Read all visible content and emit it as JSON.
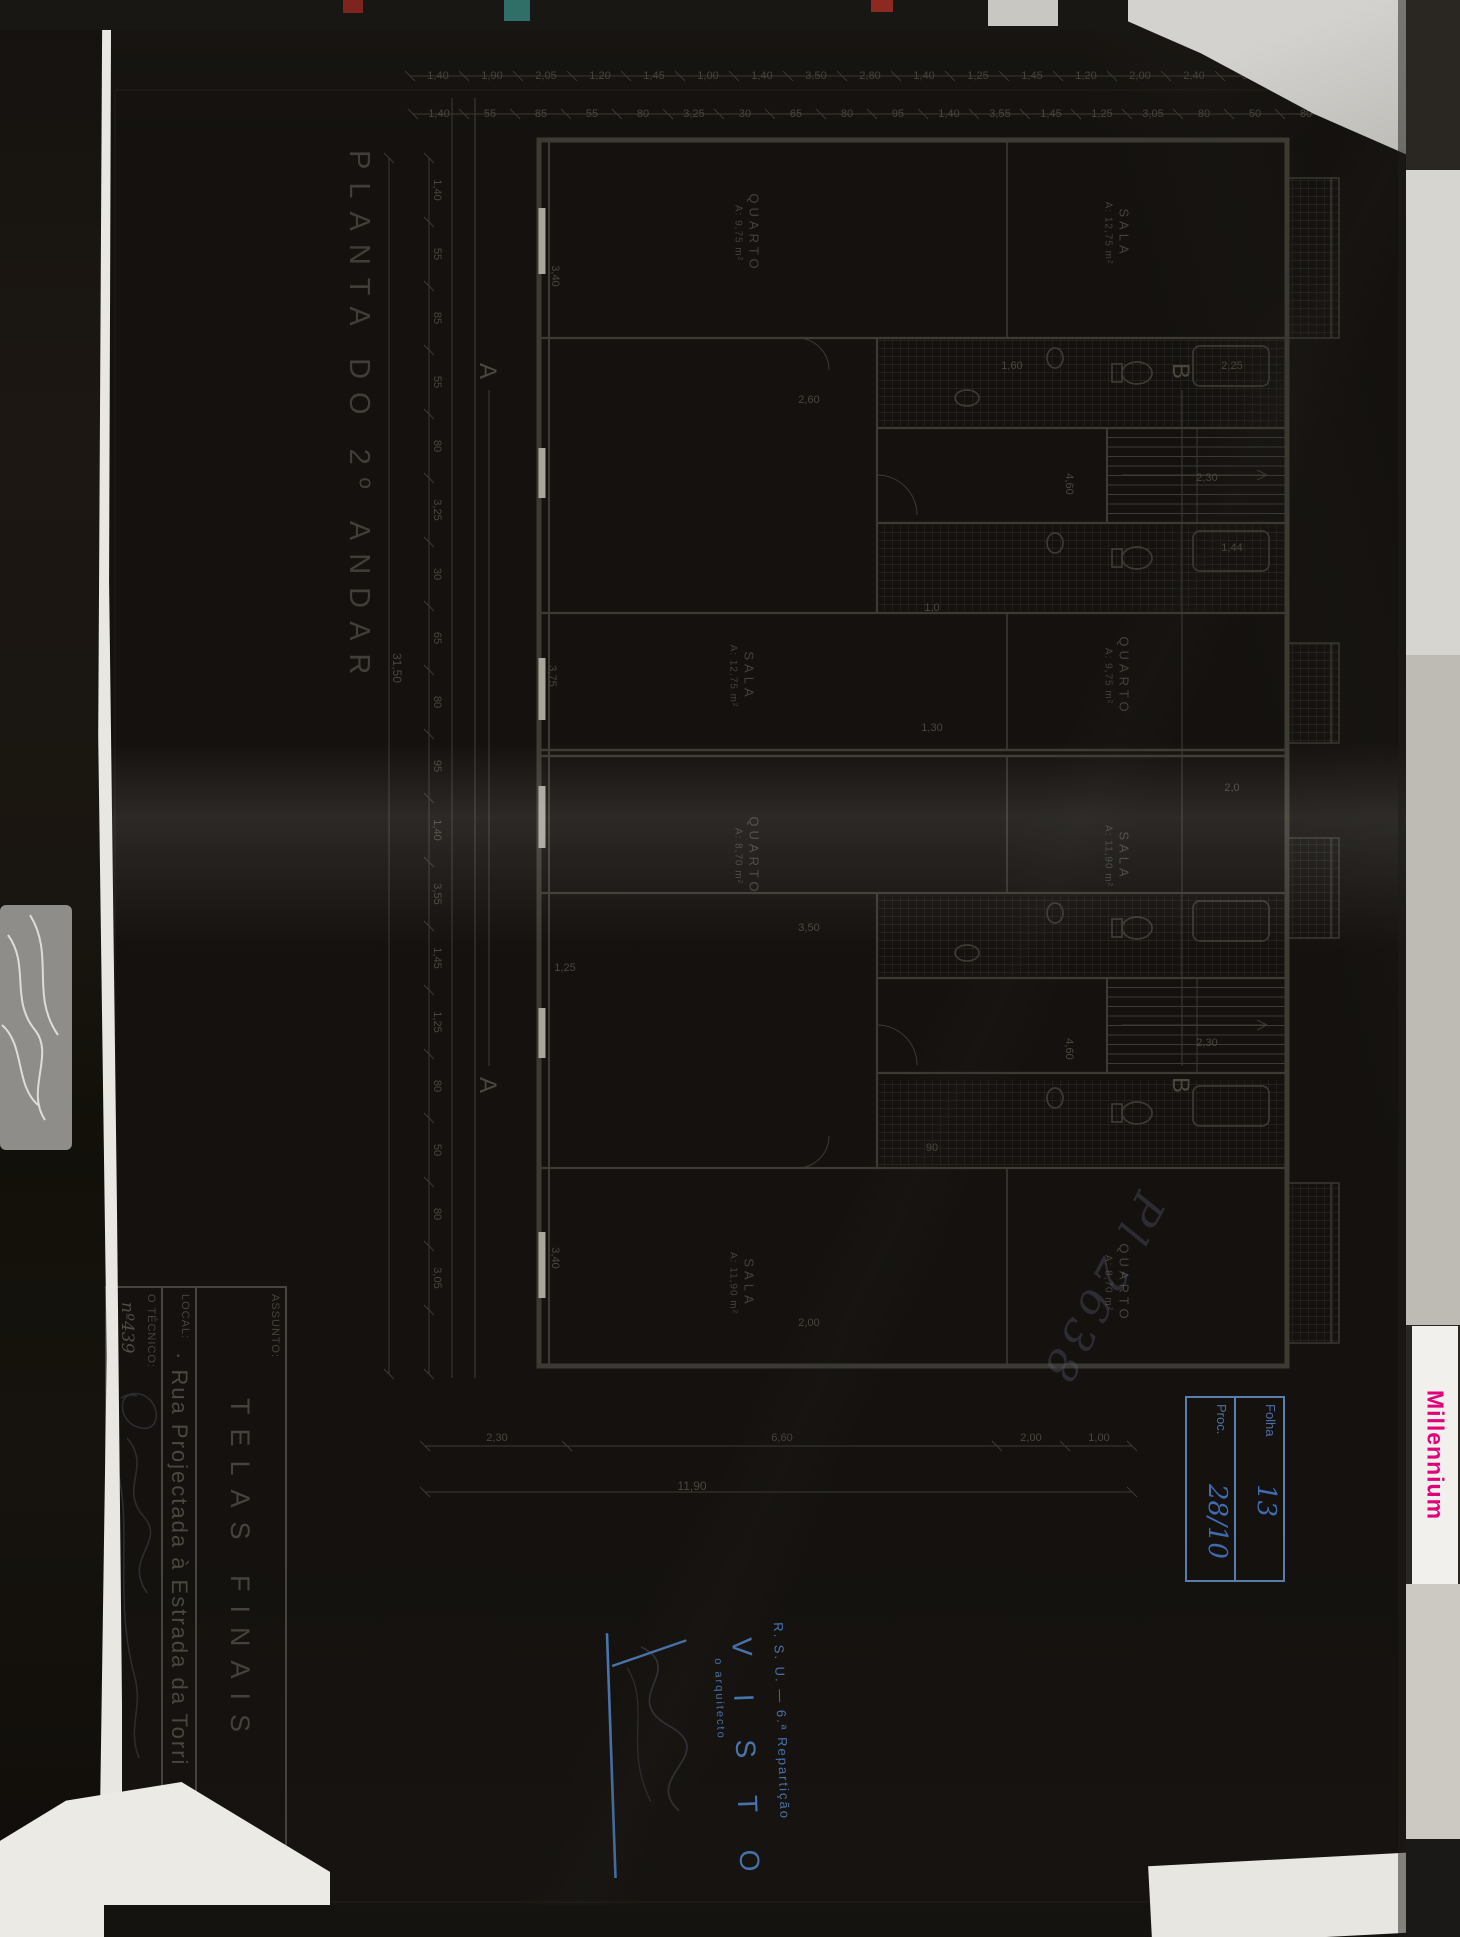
{
  "surroundings": {
    "millennium_text": "Millennium",
    "accent_magenta": "#e2007a",
    "stamp_blue": "#4a78b4",
    "paper_color": "#a7a49a",
    "ink_color": "#3b3933"
  },
  "drawing": {
    "caption": "PLANTA  DO  2º  ANDAR",
    "scribble": "Pl 2638",
    "rooms": [
      {
        "name": "SALA",
        "area": "A: 12,75 m²",
        "x": 205,
        "y": 320
      },
      {
        "name": "QUARTO",
        "area": "A: 9,75 m²",
        "x": 205,
        "y": 690
      },
      {
        "name": "QUARTO",
        "area": "A: 9,75 m²",
        "x": 648,
        "y": 320
      },
      {
        "name": "SALA",
        "area": "A: 12,75 m²",
        "x": 648,
        "y": 695
      },
      {
        "name": "SALA",
        "area": "A: 11,90 m²",
        "x": 828,
        "y": 320
      },
      {
        "name": "QUARTO",
        "area": "A: 8,70 m²",
        "x": 828,
        "y": 690
      },
      {
        "name": "QUARTO",
        "area": "A: 8,70 m²",
        "x": 1255,
        "y": 320
      },
      {
        "name": "SALA",
        "area": "A: 11,90 m²",
        "x": 1255,
        "y": 695
      }
    ],
    "section_markers": [
      {
        "t": "B",
        "x": 343,
        "y": 257
      },
      {
        "t": "B",
        "x": 1057,
        "y": 257
      },
      {
        "t": "A",
        "x": 343,
        "y": 950
      },
      {
        "t": "A",
        "x": 1057,
        "y": 950
      }
    ],
    "chain_left_outer": [
      "1,25",
      "1,40",
      "95",
      "2,40",
      "2,00",
      "1,20",
      "1,45",
      "1,25",
      "1,40",
      "2,80",
      "3,50",
      "1,40",
      "1,00",
      "1,45",
      "1,20",
      "2,05",
      "1,90",
      "1,40"
    ],
    "chain_left_inner": [
      "55",
      "80",
      "50",
      "80",
      "3,05",
      "1,25",
      "1,45",
      "3,55",
      "1,40",
      "95",
      "80",
      "65",
      "30",
      "3,25",
      "80",
      "55",
      "85",
      "55",
      "1,40"
    ],
    "chain_bottom": [
      "1,40",
      "55",
      "85",
      "55",
      "80",
      "3,25",
      "30",
      "65",
      "80",
      "95",
      "1,40",
      "3,55",
      "1,45",
      "1,25",
      "80",
      "50",
      "80",
      "3,05"
    ],
    "chain_bottom_total": "31,50",
    "chain_right": [
      {
        "t": "1,00",
        "y": 338
      },
      {
        "t": "2,00",
        "y": 406
      },
      {
        "t": "6,60",
        "y": 655
      },
      {
        "t": "2,30",
        "y": 940
      }
    ],
    "chain_right_total": "11,90",
    "interior_dims": [
      {
        "t": "4,60",
        "x": 456,
        "y": 368,
        "r": 0
      },
      {
        "t": "2,30",
        "x": 450,
        "y": 230,
        "r": -90
      },
      {
        "t": "1,30",
        "x": 700,
        "y": 505,
        "r": -90
      },
      {
        "t": "3,75",
        "x": 648,
        "y": 885,
        "r": 0
      },
      {
        "t": "2,60",
        "x": 372,
        "y": 628,
        "r": -90
      },
      {
        "t": "3,40",
        "x": 248,
        "y": 882,
        "r": 0
      },
      {
        "t": "2,25",
        "x": 338,
        "y": 205,
        "r": -90
      },
      {
        "t": "1,60",
        "x": 338,
        "y": 425,
        "r": -90
      },
      {
        "t": "1,44",
        "x": 520,
        "y": 205,
        "r": -90
      },
      {
        "t": "2,0",
        "x": 760,
        "y": 205,
        "r": -90
      },
      {
        "t": "1,0",
        "x": 580,
        "y": 505,
        "r": -90
      },
      {
        "t": "3,50",
        "x": 900,
        "y": 628,
        "r": -90
      },
      {
        "t": "1,25",
        "x": 940,
        "y": 872,
        "r": -90
      },
      {
        "t": "90",
        "x": 1120,
        "y": 505,
        "r": -90
      },
      {
        "t": "4,60",
        "x": 1021,
        "y": 368,
        "r": 0
      },
      {
        "t": "2,30",
        "x": 1015,
        "y": 230,
        "r": -90
      },
      {
        "t": "3,40",
        "x": 1230,
        "y": 882,
        "r": 0
      },
      {
        "t": "2,00",
        "x": 1295,
        "y": 628,
        "r": -90
      }
    ],
    "title_block": {
      "assunto_label": "ASSUNTO:",
      "assunto_value": "TELAS   FINAIS",
      "local_label": "LOCAL:",
      "local_value": "· Rua Projectada à Estrada da Torri",
      "tecnico_label": "O TÉCNICO:",
      "tecnico_value": "nº439",
      "sheet_code": "PL"
    },
    "stamps": {
      "dept_line": "R. S. U. — 6.ª Repartição",
      "visto": "V I S T O",
      "arch_line": "o arquitecto",
      "folha_label": "Folha",
      "folha_value": "13",
      "proc_label": "Proc.",
      "proc_value": "28/10"
    }
  }
}
